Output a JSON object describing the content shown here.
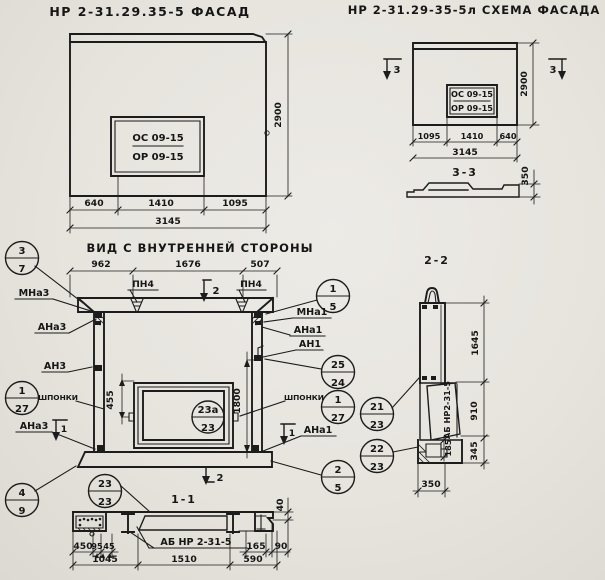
{
  "colors": {
    "ink": "#1c1c1c",
    "paper": "#e8e5df"
  },
  "facade": {
    "title": "НР 2-31.29.35-5  ФАСАД",
    "opening_top": "ОС 09-15",
    "opening_bottom": "ОР 09-15",
    "dim_height": "2900",
    "dim_640": "640",
    "dim_1410": "1410",
    "dim_1095": "1095",
    "dim_total": "3145"
  },
  "schema": {
    "title": "НР 2-31.29-35-5л  СХЕМА ФАСАДА",
    "opening_top": "ОС 09-15",
    "opening_bottom": "ОР 09-15",
    "dim_height": "2900",
    "dim_1095": "1095",
    "dim_1410": "1410",
    "dim_640": "640",
    "dim_total": "3145",
    "cut_left": "3",
    "cut_right": "3",
    "section33_title": "3-3",
    "dim_350": "350"
  },
  "inner": {
    "title": "ВИД С ВНУТРЕННЕЙ СТОРОНЫ",
    "dim_962": "962",
    "dim_1676": "1676",
    "dim_507": "507",
    "pn4_left": "ПН4",
    "pn4_right": "ПН4",
    "cut2_top": "2",
    "cut2_bottom": "2",
    "cut1_left": "1",
    "cut1_right": "1",
    "label_mna3": "МНа3",
    "label_ana3_top": "АНа3",
    "label_an3": "АН3",
    "label_shponki_left": "ШПОНКИ",
    "label_ana3_bottom": "АНа3",
    "label_mna1": "МНа1",
    "label_ana1_top": "АНа1",
    "label_an1": "АН1",
    "label_shponki_right": "ШПОНКИ",
    "label_ana1_bottom": "АНа1",
    "dim_455": "455",
    "dim_1800": "1800",
    "c37": {
      "t": "3",
      "b": "7"
    },
    "c49": {
      "t": "4",
      "b": "9"
    },
    "c127_left": {
      "t": "1",
      "b": "27"
    },
    "c15": {
      "t": "1",
      "b": "5"
    },
    "c2524": {
      "t": "25",
      "b": "24"
    },
    "c127_right": {
      "t": "1",
      "b": "27"
    },
    "c25": {
      "t": "2",
      "b": "5"
    },
    "c2123": {
      "t": "21",
      "b": "23"
    },
    "c2223": {
      "t": "22",
      "b": "23"
    },
    "c23a": {
      "t": "23а",
      "b": "23"
    }
  },
  "section11": {
    "title": "1-1",
    "c2323": {
      "t": "23",
      "b": "23"
    },
    "label_ab": "АБ НР 2-31-5",
    "dim_450": "450",
    "dim_95": "95",
    "dim_45": "45",
    "dim_1045": "1045",
    "dim_1510": "1510",
    "dim_165": "165",
    "dim_90": "90",
    "dim_590": "590",
    "dim_40": "40"
  },
  "section22": {
    "title": "2-2",
    "label_ab": "АБ НР2-31-5",
    "dim_1645": "1645",
    "dim_910": "910",
    "dim_345": "345",
    "dim_185": "185",
    "dim_350": "350"
  }
}
